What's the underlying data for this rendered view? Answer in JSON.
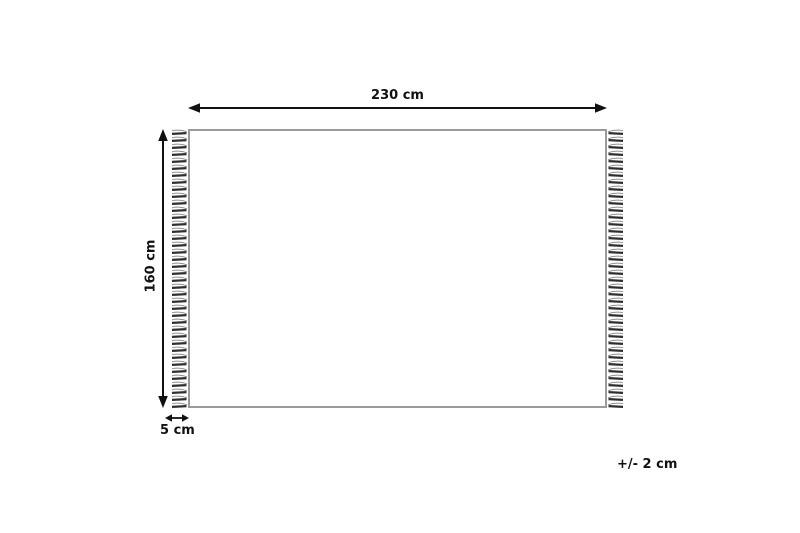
{
  "diagram": {
    "type": "rug-dimension-diagram",
    "width_label": "230 cm",
    "height_label": "160 cm",
    "fringe_label": "5 cm",
    "tolerance_label": "+/- 2 cm",
    "rug": {
      "width_cm": 230,
      "height_cm": 160,
      "fringe_cm": 5,
      "tolerance_cm": 2
    },
    "colors": {
      "arrow_line": "#111111",
      "label_text": "#111111",
      "rug_border": "#9a9a9a",
      "fringe_dark": "#2e2e2e",
      "fringe_light": "#909090",
      "background": "#ffffff"
    }
  }
}
